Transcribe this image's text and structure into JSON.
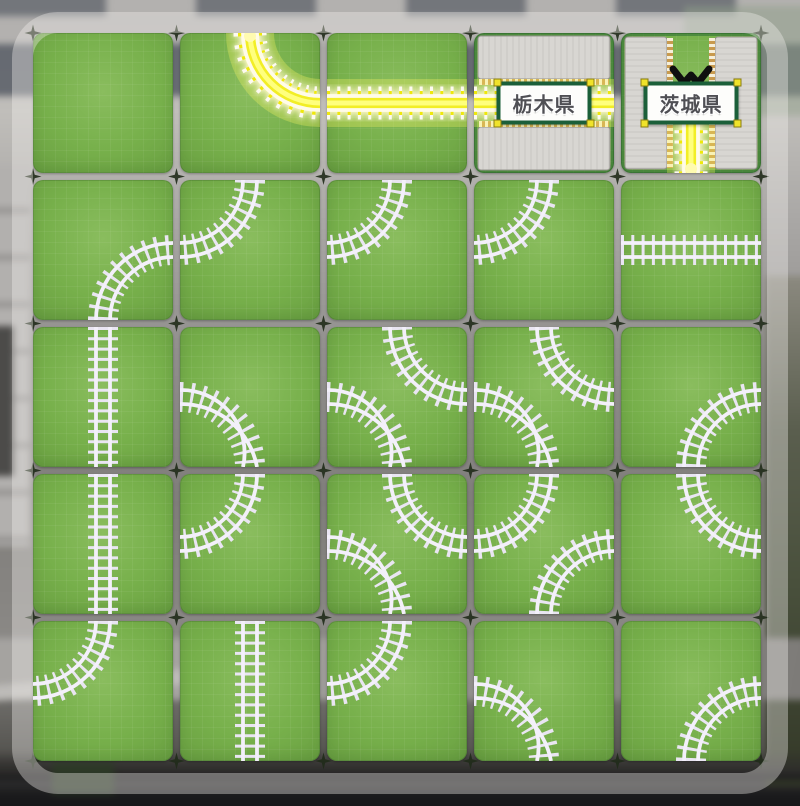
{
  "game": {
    "name": "train track puzzle board",
    "board_rows": 5,
    "board_cols": 5
  },
  "stations": {
    "tochigi": {
      "label": "栃木県",
      "orientation": "horizontal",
      "row": 1,
      "col": 4
    },
    "ibaraki": {
      "label": "茨城県",
      "orientation": "vertical",
      "row": 1,
      "col": 5,
      "has_down_arrow": true
    }
  },
  "board": {
    "tiles": [
      [
        "empty",
        "curve-tr",
        "straight-h",
        "station-h",
        "station-v"
      ],
      [
        "curve-br",
        "curve-tl",
        "curve-tl",
        "curve-tl",
        "straight-h"
      ],
      [
        "straight-v",
        "curve-bl",
        "double-tr-bl",
        "double-tr-bl",
        "curve-br"
      ],
      [
        "straight-v",
        "curve-tl",
        "double-tr-bl",
        "double-tl-br",
        "curve-tr"
      ],
      [
        "curve-tl",
        "straight-v",
        "curve-tl",
        "curve-bl",
        "curve-br"
      ]
    ],
    "highlight": [
      [
        false,
        true,
        true,
        true,
        true
      ],
      [
        false,
        false,
        false,
        false,
        false
      ],
      [
        false,
        false,
        false,
        false,
        false
      ],
      [
        false,
        false,
        false,
        false,
        false
      ],
      [
        false,
        false,
        false,
        false,
        false
      ]
    ]
  },
  "colors": {
    "tile_green": "#77b04b",
    "track_tie": "#e9e5f2",
    "track_rail": "#f3f0fa",
    "highlight_yellow": "#eee80a",
    "highlight_rail": "#fffbe8",
    "glow": "#fff9a0",
    "platform_gray": "#d8d6d2",
    "platform_edge_dot": "#c89a4e",
    "label_bg": "#fdfdfb",
    "label_border_green": "#1b5f39",
    "label_text": "#4f4f54",
    "handle_yellow": "#f0e32a",
    "chevron_black": "#0f0f0f"
  }
}
